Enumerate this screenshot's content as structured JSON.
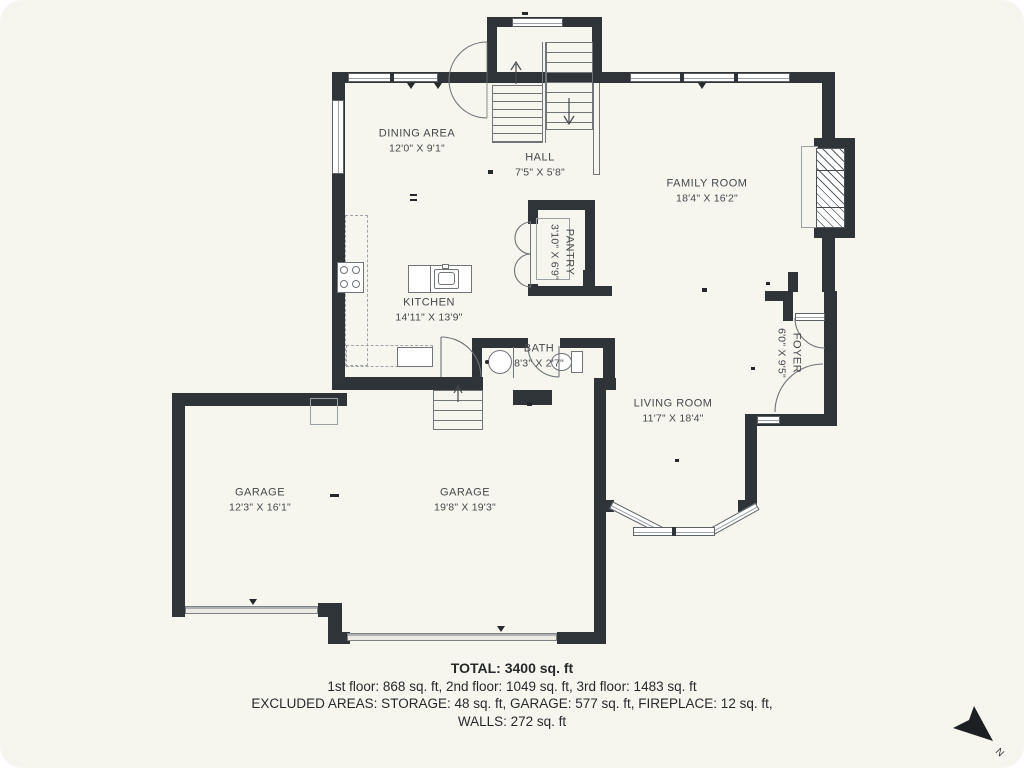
{
  "plan": {
    "rooms": [
      {
        "name": "DINING AREA",
        "dims": "12'0\" X 9'1\""
      },
      {
        "name": "HALL",
        "dims": "7'5\" X 5'8\""
      },
      {
        "name": "FAMILY ROOM",
        "dims": "18'4\" X 16'2\""
      },
      {
        "name": "PANTRY",
        "dims": "3'10\" X 6'9\""
      },
      {
        "name": "KITCHEN",
        "dims": "14'11\" X 13'9\""
      },
      {
        "name": "BATH",
        "dims": "8'3\" X 2'7\""
      },
      {
        "name": "FOYER",
        "dims": "6'0\" X 9'5\""
      },
      {
        "name": "LIVING ROOM",
        "dims": "11'7\" X 18'4\""
      },
      {
        "name": "GARAGE",
        "dims": "12'3\" X 16'1\""
      },
      {
        "name": "GARAGE",
        "dims": "19'8\" X 19'3\""
      }
    ],
    "summary": {
      "total": "TOTAL: 3400 sq. ft",
      "floors": "1st floor: 868 sq. ft, 2nd floor: 1049 sq. ft, 3rd floor: 1483 sq. ft",
      "excluded": "EXCLUDED AREAS: STORAGE: 48 sq. ft, GARAGE: 577 sq. ft, FIREPLACE: 12 sq. ft,",
      "walls": "WALLS: 272 sq. ft"
    },
    "compass": {
      "north": "N"
    },
    "colors": {
      "wall": "#2f3438",
      "background": "#f7f6ee"
    }
  }
}
